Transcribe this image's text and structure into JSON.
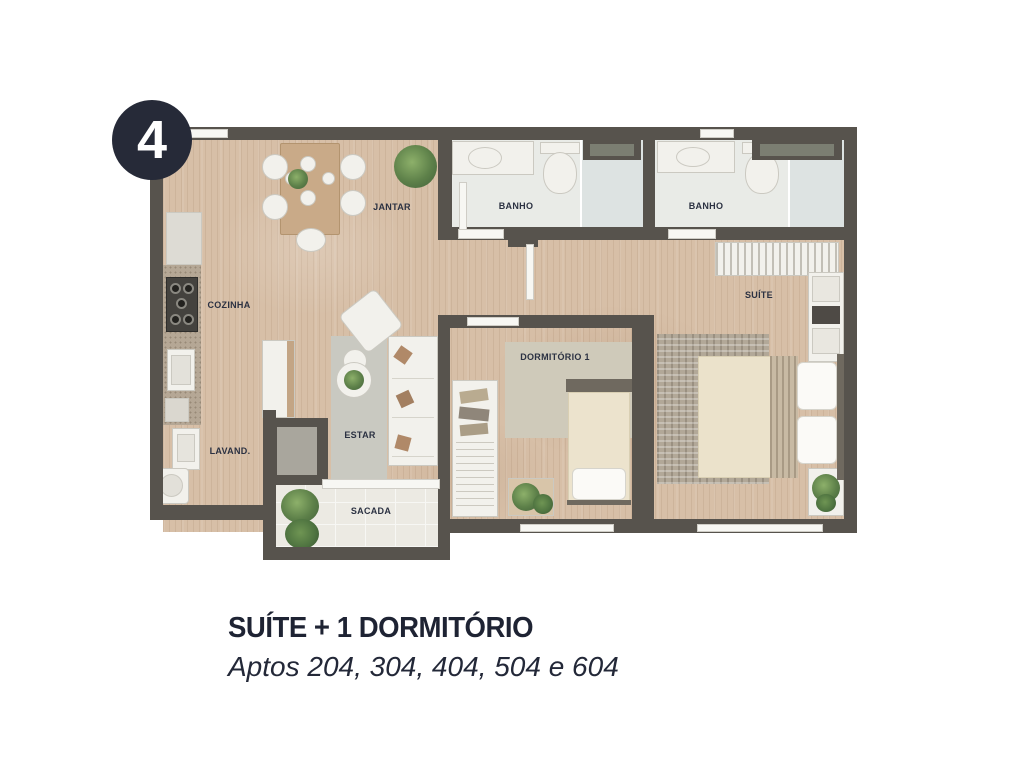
{
  "badge": {
    "number": "4"
  },
  "plan": {
    "rooms": [
      {
        "id": "jantar",
        "label": "JANTAR"
      },
      {
        "id": "banho-1",
        "label": "BANHO"
      },
      {
        "id": "banho-2",
        "label": "BANHO"
      },
      {
        "id": "cozinha",
        "label": "COZINHA"
      },
      {
        "id": "lavanderia",
        "label": "LAVAND."
      },
      {
        "id": "estar",
        "label": "ESTAR"
      },
      {
        "id": "sacada",
        "label": "SACADA"
      },
      {
        "id": "dormitorio-1",
        "label": "DORMITÓRIO 1"
      },
      {
        "id": "suite",
        "label": "SUÍTE"
      }
    ]
  },
  "caption": {
    "title": "SUÍTE + 1 DORMITÓRIO",
    "subtitle": "Aptos 204, 304, 404, 504 e 604"
  },
  "colors": {
    "wall": "#57534d",
    "wood_floor": "#d7bfa7",
    "bath_floor": "#e9ebe7",
    "badge_bg": "#262a38",
    "caption_text": "#1e2333"
  }
}
